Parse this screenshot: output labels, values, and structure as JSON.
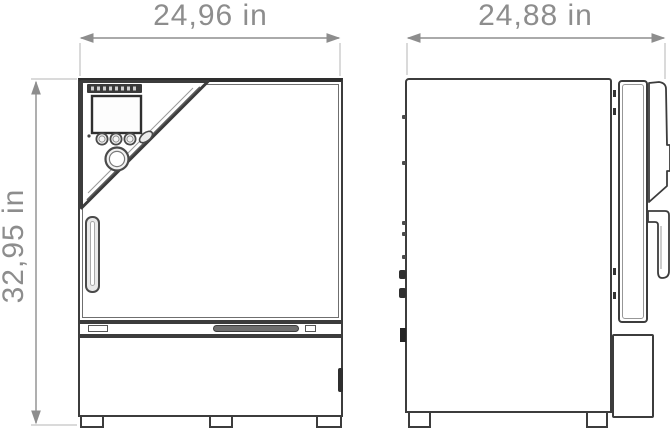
{
  "drawing_type": "technical-dimension-drawing",
  "views": {
    "front": {
      "width_dimension": "24,96 in",
      "height_dimension": "32,95 in"
    },
    "side": {
      "depth_dimension": "24,88 in"
    }
  },
  "colors": {
    "outline": "#3c3c3c",
    "thin_line": "#6f6f6f",
    "dimension_text": "#8d8d8d",
    "dimension_line": "#9a9a9a",
    "extension_line": "#b5b5b5",
    "logo_bar": "#3a3a3a",
    "vent_fill": "#6e6e6e",
    "background": "#ffffff"
  }
}
